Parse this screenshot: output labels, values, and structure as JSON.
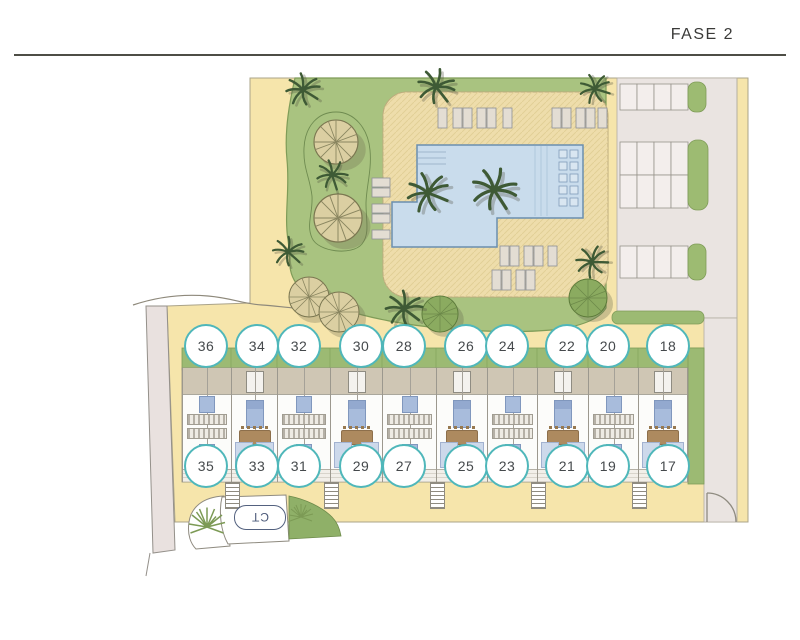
{
  "header": {
    "title": "FASE 2"
  },
  "plan": {
    "transformer_label": "CT",
    "unit_numbers": {
      "top": [
        "36",
        "34",
        "32",
        "30",
        "28",
        "26",
        "24",
        "22",
        "20",
        "18"
      ],
      "bottom": [
        "35",
        "33",
        "31",
        "29",
        "27",
        "25",
        "23",
        "21",
        "19",
        "17"
      ]
    }
  },
  "colors": {
    "accent_text": "#3a3a38",
    "paving_yellow": "#f6e5ab",
    "garden_green": "#a9c380",
    "hedge_green": "#9cba73",
    "deck_tan": "#eeddab",
    "pool_blue": "#c9dcec",
    "parking_gray": "#eae4e1",
    "circle_border": "#4fb7ba",
    "ct_blue": "#53617f"
  }
}
